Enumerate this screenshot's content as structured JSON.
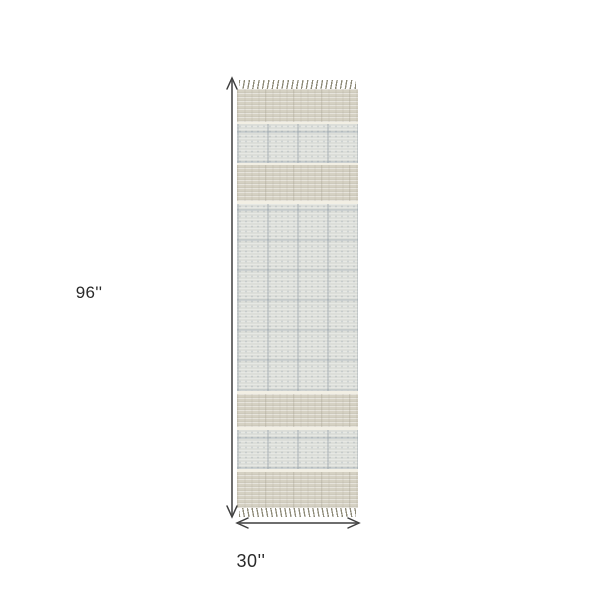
{
  "diagram": {
    "type": "rug-product-dimensions",
    "height_label": "96''",
    "width_label": "30''"
  },
  "colors": {
    "background": "#ffffff",
    "arrow": "#3e3e3e",
    "label": "#2a2a2a",
    "rug_beige": "#d5d1c3",
    "rug_grid_base": "#dcded9",
    "rug_grid_line": "#60758a",
    "rug_separator": "#f2efe4",
    "rug_fringe": "#8d8a77"
  },
  "rug": {
    "left_px": 237,
    "top_px": 80,
    "width_px": 121,
    "woven_height_px": 419,
    "fringe_height_px": 9,
    "bands": [
      {
        "kind": "beige",
        "h": 33
      },
      {
        "kind": "sep",
        "h": 2
      },
      {
        "kind": "grid",
        "h": 39
      },
      {
        "kind": "sep",
        "h": 2
      },
      {
        "kind": "beige",
        "h": 36
      },
      {
        "kind": "sep",
        "h": 3
      },
      {
        "kind": "grid",
        "h": 187
      },
      {
        "kind": "sep",
        "h": 3
      },
      {
        "kind": "beige",
        "h": 33
      },
      {
        "kind": "sep",
        "h": 3
      },
      {
        "kind": "grid",
        "h": 39
      },
      {
        "kind": "sep",
        "h": 3
      },
      {
        "kind": "beige",
        "h": 36
      }
    ]
  },
  "arrows": {
    "vertical": {
      "x": 232,
      "y1": 78,
      "y2": 517
    },
    "horizontal": {
      "y": 523,
      "x1": 237,
      "x2": 359
    }
  }
}
